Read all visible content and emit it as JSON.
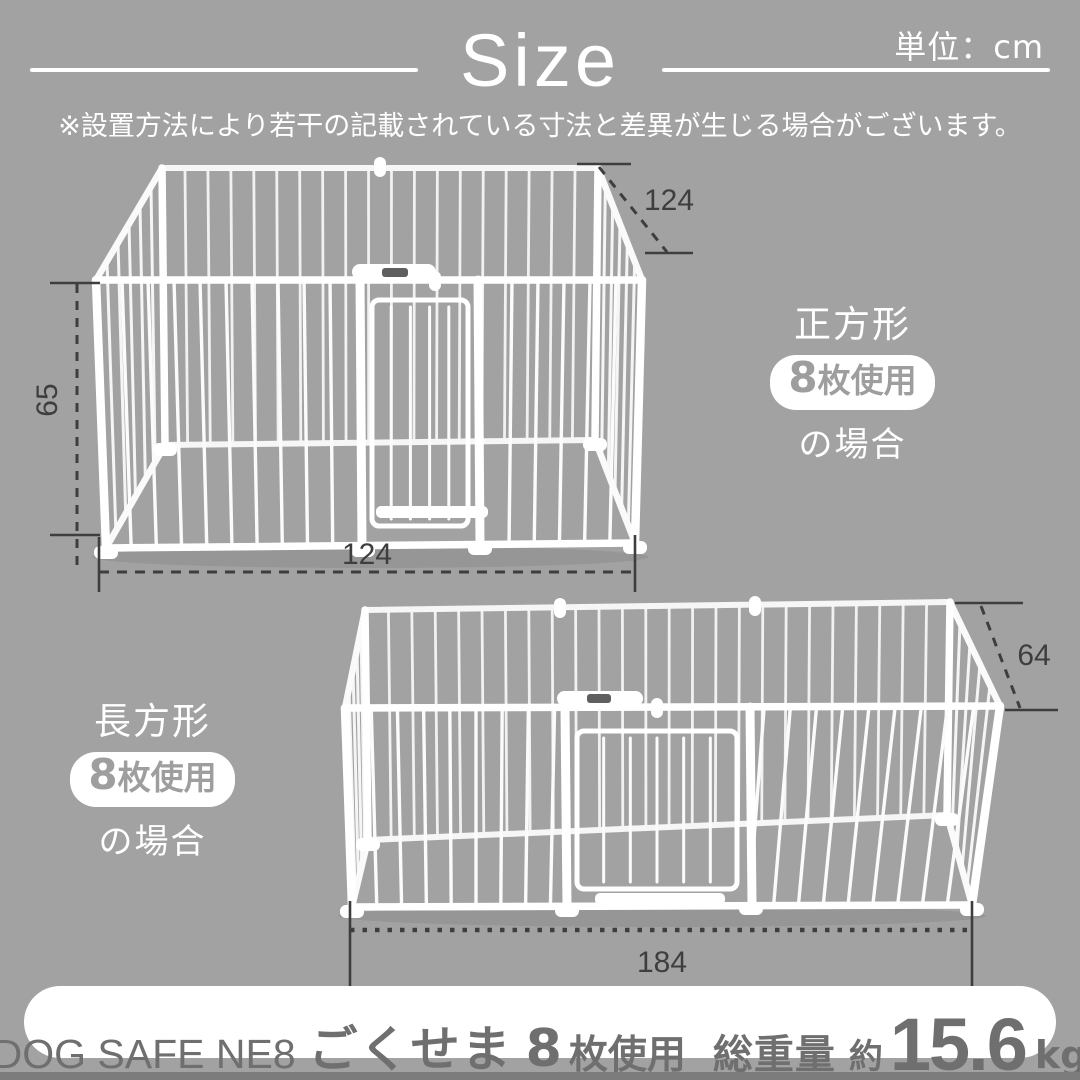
{
  "header": {
    "title": "Size",
    "unit_label": "単位：cm",
    "note": "※設置方法により若干の記載されている寸法と差異が生じる場合がございます。"
  },
  "pen_square": {
    "dim_depth": "124",
    "dim_height": "65",
    "dim_width": "124",
    "label_shape": "正方形",
    "label_count": "8",
    "label_count_suffix": "枚使用",
    "label_case": "の場合"
  },
  "pen_rect": {
    "dim_depth": "64",
    "dim_width": "184",
    "label_shape": "長方形",
    "label_count": "8",
    "label_count_suffix": "枚使用",
    "label_case": "の場合"
  },
  "footer": {
    "product_name": "DOG SAFE NE8",
    "series_name": "ごくせま",
    "panels_count": "8",
    "panels_suffix": "枚使用",
    "weight_label": "総重量",
    "weight_prefix": "約",
    "weight_value": "15.6",
    "weight_unit": "kg"
  },
  "colors": {
    "background": "#a2a2a2",
    "text_light": "#ffffff",
    "dimension_ink": "#3e3e3e",
    "pen_white": "#fcfcfc",
    "badge_text": "#9e9e9e",
    "footer_text": "#6f6f6f",
    "footer_strip": "#7c7c7c"
  }
}
